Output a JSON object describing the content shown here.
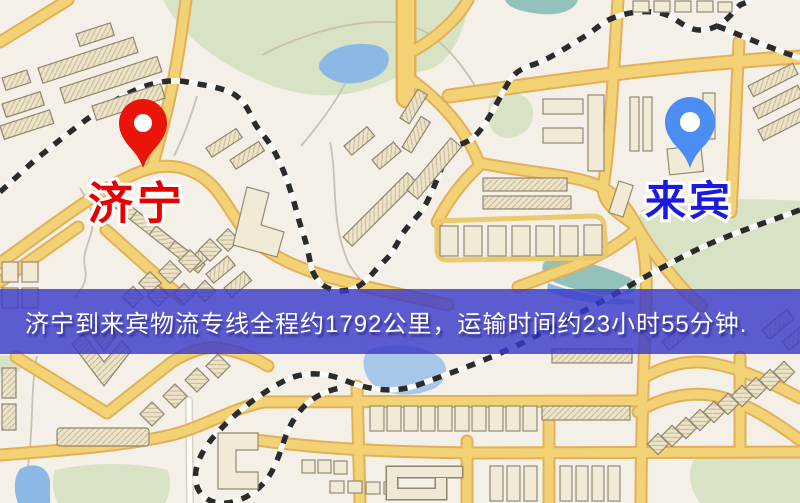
{
  "banner": {
    "text": "济宁到来宾物流专线全程约1792公里，运输时间约23小时55分钟.",
    "background_color": "#3a3acb",
    "text_color": "#ffffff"
  },
  "map": {
    "origin": {
      "name": "济宁",
      "pin_icon": "red-location-pin-icon",
      "pin_color": "#ea1408",
      "label_color": "#e60000"
    },
    "destination": {
      "name": "来宾",
      "pin_icon": "blue-location-pin-icon",
      "pin_color": "#4c8df1",
      "label_color": "#1a1ae0"
    },
    "palette": {
      "map_background": "#f5f0e7",
      "road_yellow": "#f3d276",
      "road_casing": "#e2b058",
      "minor_road": "#fdfcf8",
      "water_blue": "#8cb8e6",
      "water_teal": "#93c2ba",
      "park_green": "#d8e2c4",
      "building_fill": "#ece3c8",
      "railway_dark": "#2b2b2b"
    }
  }
}
